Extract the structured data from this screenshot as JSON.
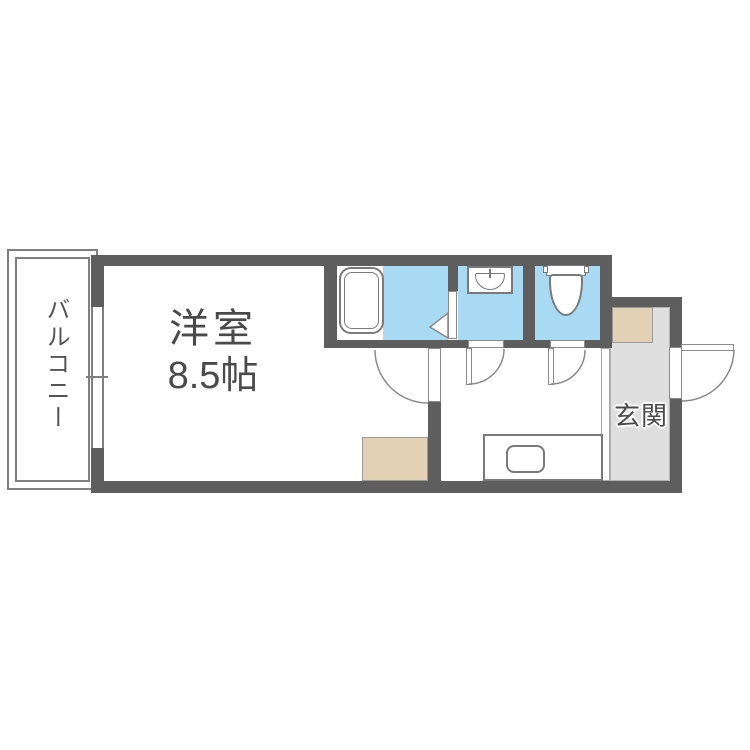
{
  "plan": {
    "type": "apartment-floor-plan",
    "rooms": {
      "balcony": {
        "label": "バルコニー"
      },
      "main_room": {
        "label": "洋室",
        "size": "8.5帖"
      },
      "entrance": {
        "label": "玄関"
      },
      "bathroom": {
        "fixture": "bathtub"
      },
      "washroom": {
        "fixture": "washbasin"
      },
      "toilet": {
        "fixture": "toilet"
      },
      "kitchen": {
        "fixture": "kitchen-sink"
      }
    },
    "colors": {
      "wall": "#5e5e5e",
      "wet_area_floor": "#a9daf3",
      "entrance_floor": "#dfdfdf",
      "storage_beige": "#e3d1b6",
      "outline": "#7f7f7f",
      "label_text": "#4a4a4a"
    }
  }
}
